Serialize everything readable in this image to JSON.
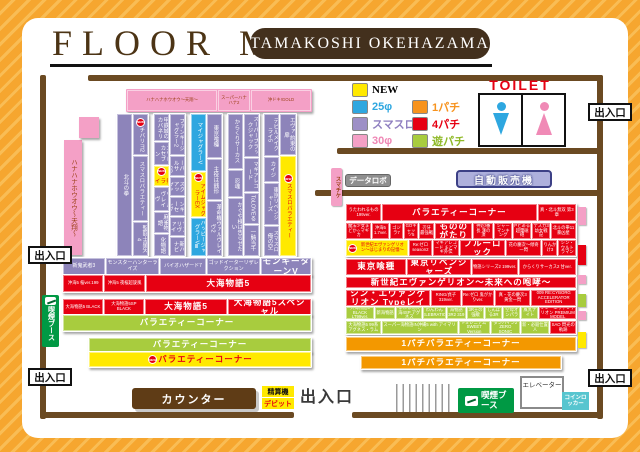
{
  "header": {
    "title": "FLOOR MAP",
    "store": "TAMAKOSHI OKEHAZAMA"
  },
  "labels": {
    "new_badge": "NEW",
    "toilet": "TOILET",
    "exit": "出入口",
    "counter": "カウンター",
    "checkout": "精算機",
    "debit": "デビット",
    "smoking_booth": "喫煙ブース",
    "elevator": "エレベーター",
    "coin_locker": "コインロッカー",
    "data_robo": "データロボ",
    "vending": "自動販売機",
    "smart_ticket": "スマチケ"
  },
  "palette": {
    "wall": "#6b4a22",
    "red": "#e60012",
    "purple": "#8d84ba",
    "green": "#a8cc3e",
    "orange": "#f39800",
    "yellow": "#ffe900",
    "pink": "#f4a0c6",
    "blue": "#2ea7e0"
  },
  "legend": {
    "col1": [
      {
        "label": "NEW",
        "color": "#ffe900",
        "fg": "#000000",
        "serif": true
      },
      {
        "label": "25φ",
        "color": "#2ea7e0",
        "fg": "#2ea7e0"
      },
      {
        "label": "スマスロ",
        "color": "#9d8fc6",
        "fg": "#8f7fc0"
      },
      {
        "label": "30φ",
        "color": "#f4a0c6",
        "fg": "#ef87b5"
      }
    ],
    "col2": [
      {
        "label": "1パチ",
        "color": "#f7931e",
        "fg": "#f7931e"
      },
      {
        "label": "4パチ",
        "color": "#e60012",
        "fg": "#e60012"
      },
      {
        "label": "遊パチ",
        "color": "#a8cc3e",
        "fg": "#8fb927"
      }
    ]
  },
  "left": {
    "topbar": [
      {
        "label": "ハナハナホウオウ〜天翔〜",
        "f": 5
      },
      {
        "label": "スーパーハナハナ2",
        "f": 1.7
      },
      {
        "label": "沖ドキ!GOLD",
        "f": 3.3
      }
    ],
    "sidebar": "ハナハナホウオウ〜天翔〜",
    "c1l": [
      {
        "label": "北斗の拳",
        "f": 1
      }
    ],
    "c1r": [
      {
        "label": "チバリヨ2",
        "f": 2.1,
        "new": true
      },
      {
        "label": "スマスロバラエティー",
        "f": 3.4
      },
      {
        "label": "聖闘士星矢4",
        "f": 1.7
      }
    ],
    "c2l": [
      {
        "label": "甲鉄城のカバネリ",
        "f": 1.5
      },
      {
        "label": "エウレカセブン",
        "f": 1.2
      },
      {
        "label": "白熱ライブ",
        "f": 1.1,
        "bg": "#ffe900",
        "fg": "#e60012",
        "new": true
      },
      {
        "label": "ヴァルヴレイヴ",
        "f": 1.3
      },
      {
        "label": "麻雀物語",
        "f": 1.1
      },
      {
        "label": "化物語",
        "f": 1.2
      }
    ],
    "c2r": [
      {
        "label": "ファンキージャグラー2",
        "f": 2.3
      },
      {
        "label": "ニューパルサーSP",
        "f": 1
      },
      {
        "label": "ディスクアップ2",
        "f": 1
      },
      {
        "label": "クランキーセレブ",
        "f": 1
      },
      {
        "label": "バーサスリヴァイズ",
        "f": 1
      },
      {
        "label": "新ハナビ",
        "f": 1
      }
    ],
    "c3l": [
      {
        "label": "マイジャグラーV",
        "f": 2.6,
        "bg": "#2ea7e0"
      },
      {
        "label": "アイムジャグラーEX",
        "f": 2,
        "bg": "#ffe900",
        "fg": "#e60012",
        "new": true
      },
      {
        "label": "ハッピージャグラーVⅢ",
        "f": 1.7,
        "bg": "#2ea7e0"
      }
    ],
    "c3r": [
      {
        "label": "東京喰種",
        "f": 1.2
      },
      {
        "label": "主役は銭形",
        "f": 1.1
      },
      {
        "label": "革命機ヴァルヴレイヴ2",
        "f": 1.5
      }
    ],
    "c4l": [
      {
        "label": "からくりサーカス",
        "f": 1.7
      },
      {
        "label": "忍魂",
        "f": 0.8
      },
      {
        "label": "かぐや様は告らせたい",
        "f": 1.8
      }
    ],
    "c4r": [
      {
        "label": "スーパーブラックジャック",
        "f": 1.4
      },
      {
        "label": "マギアレコード",
        "f": 1.1
      },
      {
        "label": "ToLOVEる",
        "f": 1
      },
      {
        "label": "一騎当千",
        "f": 1
      }
    ],
    "c5l": [
      {
        "label": "デビルメイクライ5",
        "f": 1.4
      },
      {
        "label": "カイジ",
        "f": 0.8
      },
      {
        "label": "東京リベンジャーズ",
        "f": 1.4
      },
      {
        "label": "スマスロ俺の空",
        "f": 1
      }
    ],
    "c5r": [
      {
        "label": "エヴァ 約束の扉",
        "f": 1
      },
      {
        "label": "スマスロバラエティー",
        "f": 2.5,
        "bg": "#ffe900",
        "fg": "#e60012",
        "new": true
      }
    ],
    "r1": [
      {
        "label": "新鬼武者3",
        "f": 1
      },
      {
        "label": "モンスターハンターライズ",
        "f": 1.3
      },
      {
        "label": "バイオハザード7",
        "f": 1.1
      },
      {
        "label": "ゴッドイーターリザレクション",
        "f": 1.3
      },
      {
        "label": "モンキーターンV",
        "f": 1.2,
        "big": true
      }
    ],
    "r2": [
      {
        "label": "沖海5 桜ver.199",
        "f": 0.8
      },
      {
        "label": "沖海5 夜桜超旋風",
        "f": 0.8
      },
      {
        "label": "大海物語5",
        "f": 3.4,
        "big": true
      }
    ],
    "r3": [
      {
        "label": "大海物語5 BLACK",
        "f": 0.8
      },
      {
        "label": "大海物語5SP BLACK",
        "f": 0.8
      },
      {
        "label": "大海物語5",
        "f": 1.7,
        "big": true
      },
      {
        "label": "大海物語5スペシャル",
        "f": 1.7,
        "big": true
      }
    ],
    "r4": [
      {
        "label": "バラエティーコーナー",
        "f": 1,
        "big": true
      }
    ],
    "r5": [
      {
        "label": "バラエティーコーナー",
        "f": 1,
        "big": true
      }
    ],
    "r6": [
      {
        "label": "バラエティーコーナー",
        "f": 1,
        "big": true,
        "new": true
      }
    ]
  },
  "right": {
    "rA": [
      {
        "label": "うたわれるもの 199ver.",
        "f": 1
      },
      {
        "label": "バラエティーコーナー",
        "f": 4.6,
        "big": true
      },
      {
        "label": "真・北斗無双 第3章",
        "f": 1.1
      }
    ],
    "rB": [
      {
        "label": "魔法少女まどか☆マギカ",
        "f": 1.2
      },
      {
        "label": "沖海5 1.7ver.",
        "f": 0.75
      },
      {
        "label": "ゴジラ7",
        "f": 0.6
      },
      {
        "label": "GOキャッツ5",
        "f": 0.6
      },
      {
        "label": "刃牙 最強戦",
        "f": 0.7
      },
      {
        "label": "もののがたり",
        "f": 1.8,
        "big": true
      },
      {
        "label": "押忍!番長 漢の頂",
        "f": 0.95
      },
      {
        "label": "シャーマンキング",
        "f": 0.8
      },
      {
        "label": "Pとある超電磁砲",
        "f": 0.85
      },
      {
        "label": "デスカ3 幼女戦記",
        "f": 0.8
      },
      {
        "label": "北斗の拳11 暴凶星",
        "f": 1.2
      }
    ],
    "rC": [
      {
        "label": "新世紀エヴァンゲリオン〜はじまりの記憶〜",
        "f": 2.5,
        "bg": "#ffe900",
        "fg": "#e60012",
        "new": true
      },
      {
        "label": "Re:ゼロ season2",
        "f": 0.9
      },
      {
        "label": "マギアレコード まどマギ外伝",
        "f": 1
      },
      {
        "label": "ブルーロック",
        "f": 1.8,
        "big": true
      },
      {
        "label": "花の慶次〜傾奇一閃",
        "f": 1.4
      },
      {
        "label": "りんかけ3",
        "f": 0.55
      },
      {
        "label": "シン・ウルトラマン",
        "f": 0.65
      }
    ],
    "rD": [
      {
        "label": "東京喰種",
        "f": 2,
        "big": true
      },
      {
        "label": "東京リベンジャーズ",
        "f": 2.1,
        "big": true
      },
      {
        "label": "物語シリーズ2 199ver.",
        "f": 1.5
      },
      {
        "label": "からくりサーカス2 甘ver.",
        "f": 1.9
      }
    ],
    "rE": [
      {
        "label": "新世紀エヴァンゲリオン〜未来への咆哮〜",
        "f": 1,
        "big": true
      }
    ],
    "rF": [
      {
        "label": "シン・エヴァンゲリオン Typeレイ",
        "f": 2.7,
        "big": true
      },
      {
        "label": "RING/貞子 319ver.",
        "f": 0.9
      },
      {
        "label": "Re:ゼロ 鬼がかりver.",
        "f": 1
      },
      {
        "label": "真・花の慶次3 黄金一閃",
        "f": 1.1
      },
      {
        "label": "009 RE:CYBORG ACCELERATOR EDITION",
        "f": 1.4
      }
    ],
    "rG": [
      {
        "label": "大海物語5 BLACK LT99ver.",
        "f": 1.2
      },
      {
        "label": "新海物語",
        "f": 0.85
      },
      {
        "label": "まわるん大海4SP アグネス",
        "f": 1.1
      },
      {
        "label": "わんわん CELEBRATION",
        "f": 0.95
      },
      {
        "label": "海物語3R2 319",
        "f": 0.8
      },
      {
        "label": "3R王の強敵",
        "f": 0.7
      },
      {
        "label": "しんぼる3R",
        "f": 0.7
      },
      {
        "label": "空母オンパラ",
        "f": 0.7
      },
      {
        "label": "風丸ナイト",
        "f": 0.7
      },
      {
        "label": "シン・エヴァンゲリオン PREMIUM MODEL",
        "f": 1.6,
        "bg": "#e60012"
      }
    ],
    "rH": [
      {
        "label": "大海物語5 99系アグネス・ラム",
        "f": 1.1
      },
      {
        "label": "スーパー海物語IN沖縄5 with アイマリン",
        "f": 2.5
      },
      {
        "label": "Fミレニアム SWEET Version",
        "f": 1
      },
      {
        "label": "ダンバイン2 ZERO SONIC",
        "f": 0.9
      },
      {
        "label": "新・必殺仕置人",
        "f": 0.9
      },
      {
        "label": "SAO 閃光の軌跡",
        "f": 0.8,
        "bg": "#e60012"
      }
    ],
    "o1": [
      {
        "label": "1パチバラエティーコーナー",
        "f": 1,
        "big": true
      }
    ],
    "o2": [
      {
        "label": "1パチバラエティーコーナー",
        "f": 1,
        "big": true
      }
    ],
    "caps": [
      {
        "bg": "#f4a0c6",
        "h": 18
      },
      {
        "bg": "#e60012",
        "h": 20,
        "mt": 20
      },
      {
        "bg": "#f4a0c6",
        "h": 9,
        "mt": 10
      },
      {
        "bg": "#a8cc3e",
        "h": 13,
        "mt": 10
      },
      {
        "bg": "#f4a0c6",
        "h": 9,
        "mt": 4
      },
      {
        "bg": "#ffe900",
        "h": 16,
        "mt": 12
      }
    ]
  }
}
